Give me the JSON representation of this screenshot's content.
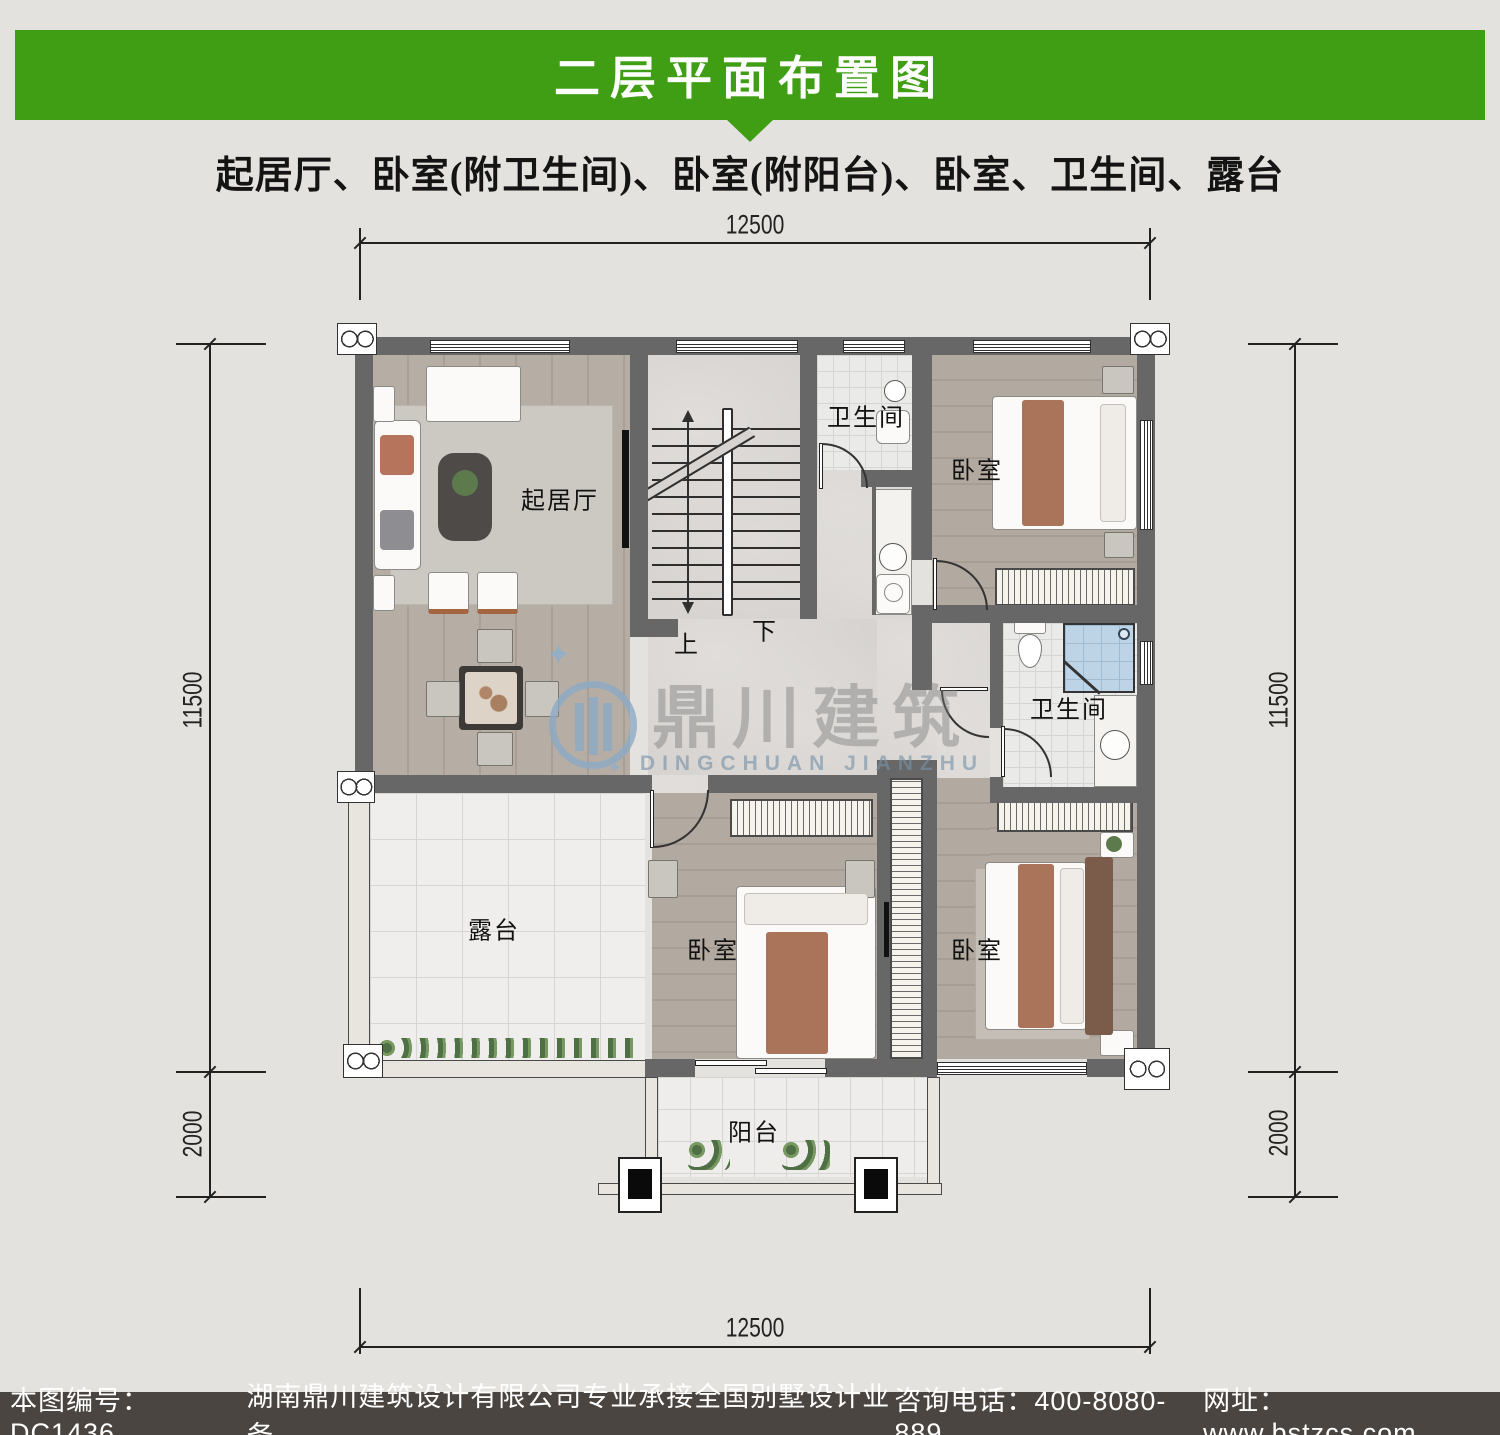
{
  "header": {
    "title": "二层平面布置图"
  },
  "subtitle": "起居厅、卧室(附卫生间)、卧室(附阳台)、卧室、卫生间、露台",
  "dims": {
    "top_width": "12500",
    "bottom_width": "12500",
    "left_height": "11500",
    "left_ext": "2000",
    "right_height": "11500",
    "right_ext": "2000"
  },
  "rooms": {
    "living": {
      "label": "起居厅"
    },
    "bath_top": {
      "label": "卫生间"
    },
    "bedroom_tr": {
      "label": "卧室"
    },
    "bath_mid": {
      "label": "卫生间"
    },
    "terrace": {
      "label": "露台"
    },
    "bedroom_bm": {
      "label": "卧室"
    },
    "bedroom_br": {
      "label": "卧室"
    },
    "balcony": {
      "label": "阳台"
    }
  },
  "stairs": {
    "up": "上",
    "down": "下"
  },
  "watermark": {
    "cn": "鼎川建筑",
    "en": "DINGCHUAN JIANZHU"
  },
  "footer": {
    "drawing_no": "本图编号：DC1436",
    "company": "湖南鼎川建筑设计有限公司专业承接全国别墅设计业务",
    "phone": "咨询电话：400-8080-889",
    "website": "网址：www.bstzcs.com"
  },
  "colors": {
    "header_green": "#3f9e14",
    "footer_bg": "#4a4540",
    "wall_gray": "#676767",
    "watermark_blue": "#8fb3cc"
  }
}
